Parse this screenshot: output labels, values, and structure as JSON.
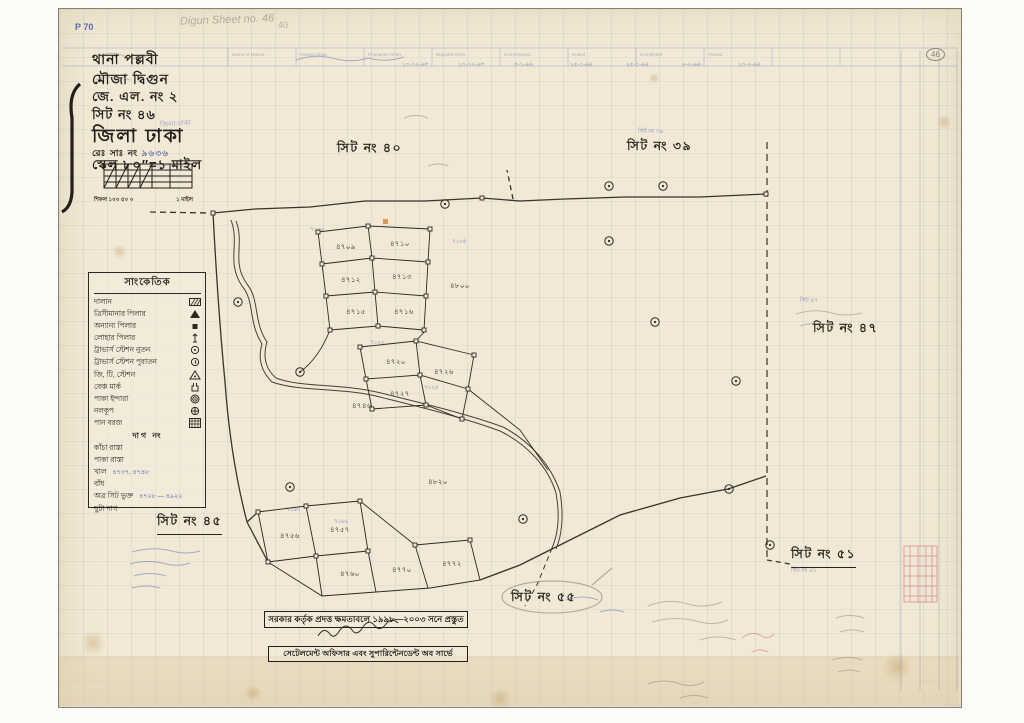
{
  "colors": {
    "paper": "#f1e9d5",
    "ink": "#2e2822",
    "blue": "#4f63ae",
    "pencil": "#8d8676"
  },
  "top": {
    "p_number": "P 70",
    "pencil_title": "Digun Sheet no. 46",
    "pencil_num": "40",
    "circled_num": "46",
    "form_columns": [
      "Name of Mouza",
      "Kistwar Khan",
      "Khanapuri Khan",
      "Bujharat Khan",
      "Commenced",
      "Ended",
      "Completed",
      "Traced"
    ],
    "blue_dates": [
      "১০-১২-৯৮",
      "২০-১২-৯৮",
      "৫-১-৯৯",
      "১৫-১-৯৯",
      "২৫-১-৯৯",
      "৮-২-৯৯",
      "২০-২-৯৯"
    ]
  },
  "header": {
    "thana": "থানা  পল্লবী",
    "mouza": "মৌজা  দ্বিগুন",
    "jl": "জে. এল. নং  ২",
    "sheet": "সিট নং  ৪৬",
    "district": "জিলা ঢাকা",
    "district_stamp": "জিলা-ঢাকা",
    "reg_label": "রেঃ সাঃ নং",
    "reg_value": "৯৬৩৬",
    "scale": "স্কেল ৮০″=১ মাইল",
    "chain_label": "শিকল ১০০   ৫০   ০",
    "mile_label": "১ মাইল"
  },
  "legend": {
    "title": "সাংকেতিক",
    "items": [
      {
        "label": "দালান",
        "symbol": "hatch-rect"
      },
      {
        "label": "ত্রিসীমানার পিলার",
        "symbol": "triangle-filled"
      },
      {
        "label": "অন্যান্য পিলার",
        "symbol": "square-small"
      },
      {
        "label": "লোহার পিলার",
        "symbol": "iron-pillar"
      },
      {
        "label": "ট্রাভার্স স্টেশন নুতন",
        "symbol": "circle-dot"
      },
      {
        "label": "ট্রাভার্স স্টেশন পুরাতন",
        "symbol": "circle-tail"
      },
      {
        "label": "জি, টি, স্টেশন",
        "symbol": "triangle-dot"
      },
      {
        "label": "বেঞ্চ মার্ক",
        "symbol": "benchmark"
      },
      {
        "label": "পাকা ইন্দারা",
        "symbol": "double-circle-dot"
      },
      {
        "label": "নলকূপ",
        "symbol": "circle-cross"
      },
      {
        "label": "পান বরজ",
        "symbol": "crosshatch-rect"
      }
    ],
    "dag_heading": "দাগ নং",
    "sub_items": [
      {
        "label": "কাঁচা রাস্তা",
        "note": ""
      },
      {
        "label": "পাকা রাস্তা",
        "note": ""
      },
      {
        "label": "খাল",
        "note": "৪৭৩৭, ৪৭৪৮"
      },
      {
        "label": "বাঁধ",
        "note": ""
      },
      {
        "label": "অত্র সিট ভুক্ত",
        "note": "৪৭০৮ — ৪৯২০"
      },
      {
        "label": "ছুটা দাগ",
        "note": ""
      }
    ]
  },
  "sheets": [
    {
      "label": "সিট নং ৪০",
      "x": 337,
      "y": 140,
      "style": "plain"
    },
    {
      "label": "সিট নং ৩৯",
      "x": 627,
      "y": 138,
      "style": "plain"
    },
    {
      "label": "সিট নং ৪৭",
      "x": 813,
      "y": 320,
      "style": "plain"
    },
    {
      "label": "সিট নং ৪৫",
      "x": 157,
      "y": 513,
      "style": "underline"
    },
    {
      "label": "সিট নং ৫৫",
      "x": 511,
      "y": 589,
      "style": "oval"
    },
    {
      "label": "সিট নং ৫১",
      "x": 791,
      "y": 546,
      "style": "underline"
    }
  ],
  "sheet_notes": [
    {
      "text": "সিট নং ৩৯",
      "x": 638,
      "y": 127
    },
    {
      "text": "সিট নং ৫১",
      "x": 791,
      "y": 566
    },
    {
      "text": "সিট ৪৭",
      "x": 800,
      "y": 296
    }
  ],
  "plots": [
    {
      "n": "৪৭০৯",
      "x": 336,
      "y": 241
    },
    {
      "n": "৪৭১০",
      "x": 390,
      "y": 238
    },
    {
      "n": "৪৮০০",
      "x": 450,
      "y": 280
    },
    {
      "n": "৪৭১২",
      "x": 341,
      "y": 274
    },
    {
      "n": "৪৭১৩",
      "x": 392,
      "y": 271
    },
    {
      "n": "৪৭১৫",
      "x": 346,
      "y": 306
    },
    {
      "n": "৪৭১৬",
      "x": 394,
      "y": 306
    },
    {
      "n": "৪৭২০",
      "x": 386,
      "y": 356
    },
    {
      "n": "৪৭২৬",
      "x": 434,
      "y": 366
    },
    {
      "n": "৪৭২৭",
      "x": 390,
      "y": 388
    },
    {
      "n": "৪৭৪৬",
      "x": 352,
      "y": 400
    },
    {
      "n": "৪৮২০",
      "x": 428,
      "y": 476
    },
    {
      "n": "৪৭৫৬",
      "x": 280,
      "y": 530
    },
    {
      "n": "৪৭৫৭",
      "x": 330,
      "y": 524
    },
    {
      "n": "৪৭৬০",
      "x": 340,
      "y": 568
    },
    {
      "n": "৪৭৭০",
      "x": 392,
      "y": 564
    },
    {
      "n": "৪৭৭২",
      "x": 442,
      "y": 558
    }
  ],
  "blue_marks": [
    {
      "n": "৭১০০",
      "x": 310,
      "y": 226
    },
    {
      "n": "৭১০৫",
      "x": 452,
      "y": 238
    },
    {
      "n": "৭১২০",
      "x": 370,
      "y": 339
    },
    {
      "n": "৭১২৫",
      "x": 424,
      "y": 384
    },
    {
      "n": "৭১৬০",
      "x": 286,
      "y": 506
    },
    {
      "n": "৭১৬২",
      "x": 334,
      "y": 518
    }
  ],
  "stamp": {
    "line1": "সরকার কর্তৃক প্রদত্ত ক্ষমতাবলে ১৯৯৮—২০০৩ সনে প্রস্তুত",
    "line2": "সেটেলমেন্ট অফিসার এবং সুপারিন্টেনডেন্ট অব সার্ভে"
  }
}
